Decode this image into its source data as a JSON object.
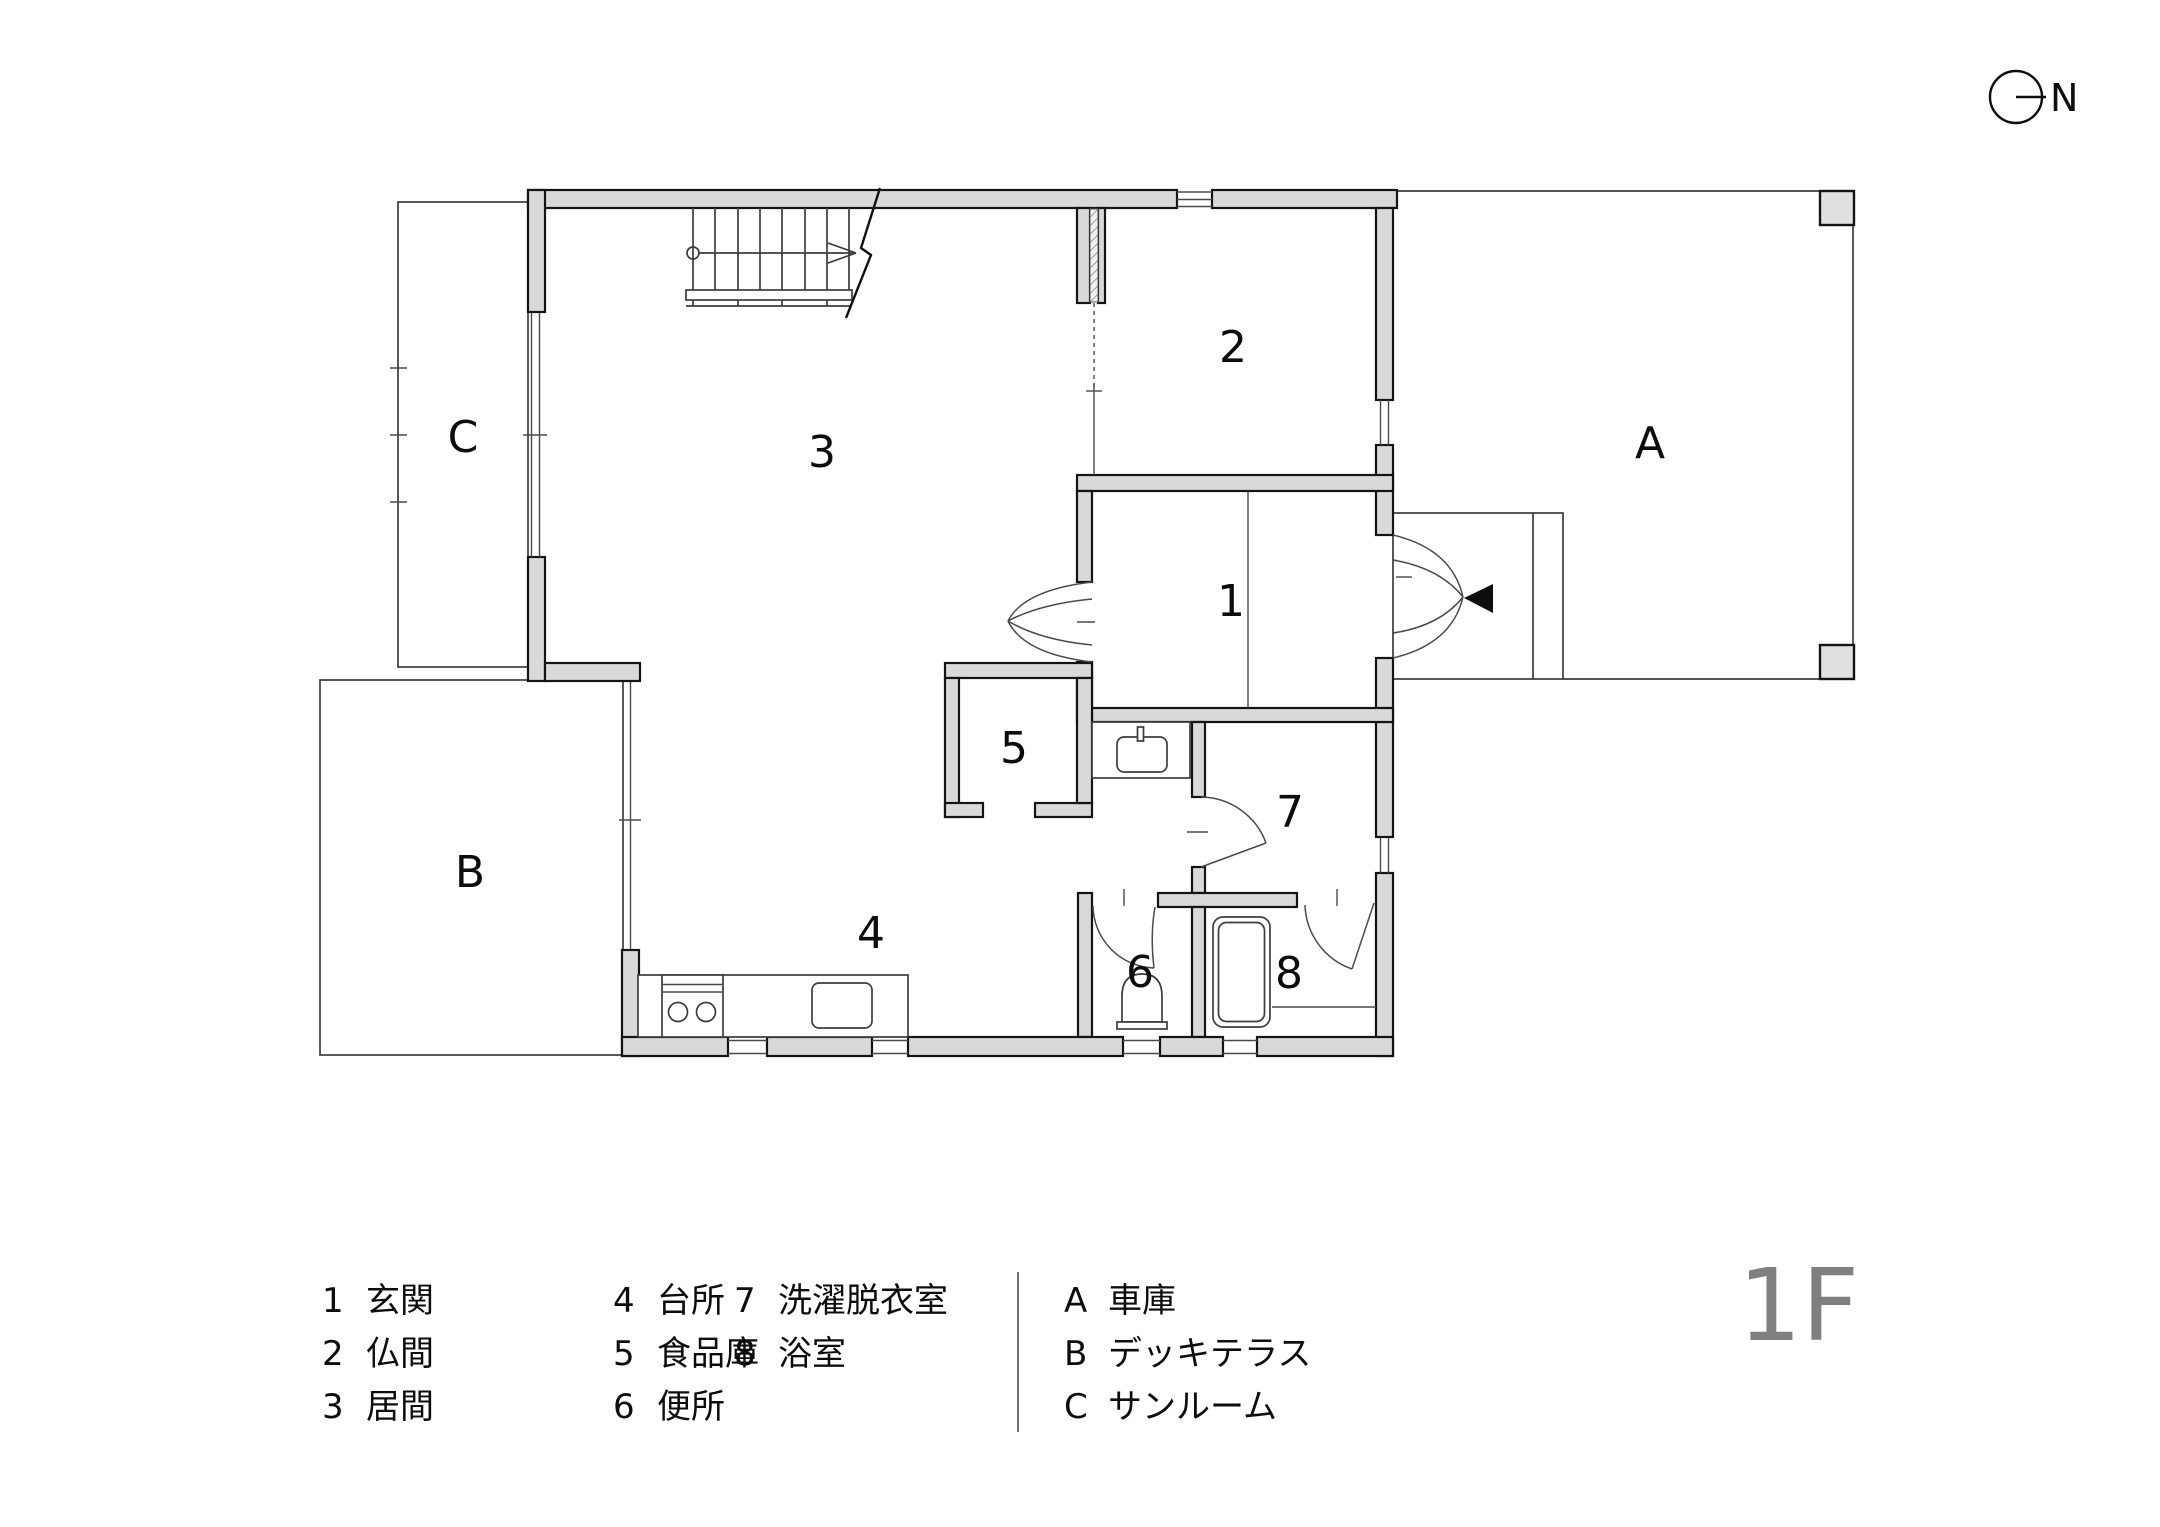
{
  "floor_label": "1F",
  "compass": {
    "label": "N"
  },
  "rooms": {
    "r1": {
      "number": "1",
      "name": "玄関"
    },
    "r2": {
      "number": "2",
      "name": "仏間"
    },
    "r3": {
      "number": "3",
      "name": "居間"
    },
    "r4": {
      "number": "4",
      "name": "台所"
    },
    "r5": {
      "number": "5",
      "name": "食品庫"
    },
    "r6": {
      "number": "6",
      "name": "便所"
    },
    "r7": {
      "number": "7",
      "name": "洗濯脱衣室"
    },
    "r8": {
      "number": "8",
      "name": "浴室"
    },
    "rA": {
      "number": "A",
      "name": "車庫"
    },
    "rB": {
      "number": "B",
      "name": "デッキテラス"
    },
    "rC": {
      "number": "C",
      "name": "サンルーム"
    }
  },
  "colors": {
    "wall_fill": "#d9d9d9",
    "floor_label_gray": "#7f7f7f"
  }
}
